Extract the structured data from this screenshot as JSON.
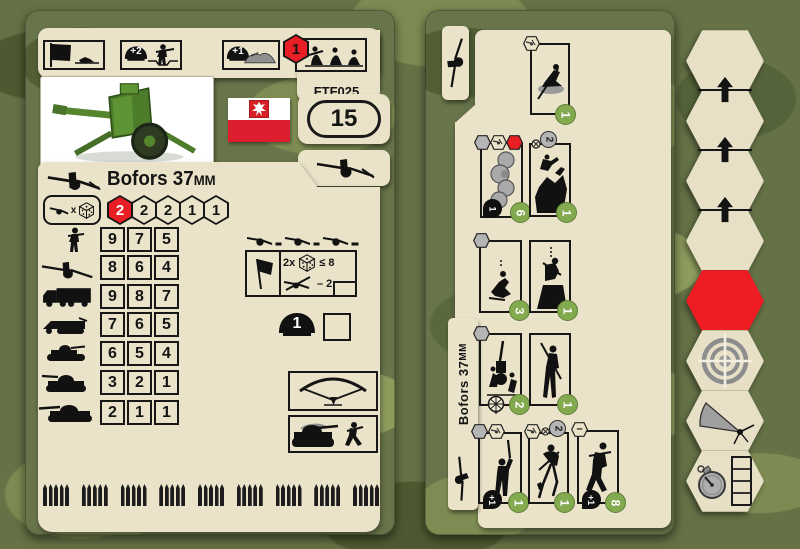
{
  "left_card": {
    "code": "FTF025",
    "points": "15",
    "title": "Bofors 37",
    "title_unit": "MM",
    "nation": "Poland",
    "modifiers": {
      "entrench_infantry": "+2",
      "entrench_gun": "+1",
      "crew_move_cost": "1"
    },
    "attack": {
      "times_label": "x",
      "hexes": [
        "2",
        "2",
        "2",
        "1",
        "1"
      ]
    },
    "range_rows": [
      {
        "target": "infantry",
        "values": [
          "9",
          "7",
          "5"
        ]
      },
      {
        "target": "anti-tank-gun",
        "values": [
          "8",
          "6",
          "4"
        ]
      },
      {
        "target": "truck",
        "values": [
          "9",
          "8",
          "7"
        ]
      },
      {
        "target": "halftrack",
        "values": [
          "7",
          "6",
          "5"
        ]
      },
      {
        "target": "light-armor",
        "values": [
          "6",
          "5",
          "4"
        ]
      },
      {
        "target": "medium-tank",
        "values": [
          "3",
          "2",
          "1"
        ]
      },
      {
        "target": "heavy-tank",
        "values": [
          "2",
          "1",
          "1"
        ]
      }
    ],
    "fire_check": {
      "multiplier": "2x",
      "threshold": "≤ 8",
      "modifier": "– 2"
    },
    "helmet_value": "1"
  },
  "right_card": {
    "title": "Bofors 37",
    "title_unit": "MM",
    "minus_badge": "–",
    "rows": [
      {
        "boxes": [
          {
            "cost": "1"
          }
        ]
      },
      {
        "boxes": [
          {
            "cost": "6",
            "marker": "1"
          },
          {
            "cost": "1",
            "badge": "2"
          }
        ]
      },
      {
        "boxes": [
          {
            "cost": "3"
          },
          {
            "cost": "1"
          }
        ]
      },
      {
        "boxes": [
          {
            "cost": "2"
          },
          {
            "cost": "1"
          }
        ]
      },
      {
        "boxes": [
          {
            "cost": "1",
            "marker": "+1"
          },
          {
            "cost": "1",
            "badge": "2"
          },
          {
            "cost": "8",
            "marker": "+1"
          }
        ]
      }
    ]
  },
  "colors": {
    "camo_base": "#657246",
    "tan": "#eae3c9",
    "red": "#e81e24",
    "cost_green": "#84aa50"
  }
}
